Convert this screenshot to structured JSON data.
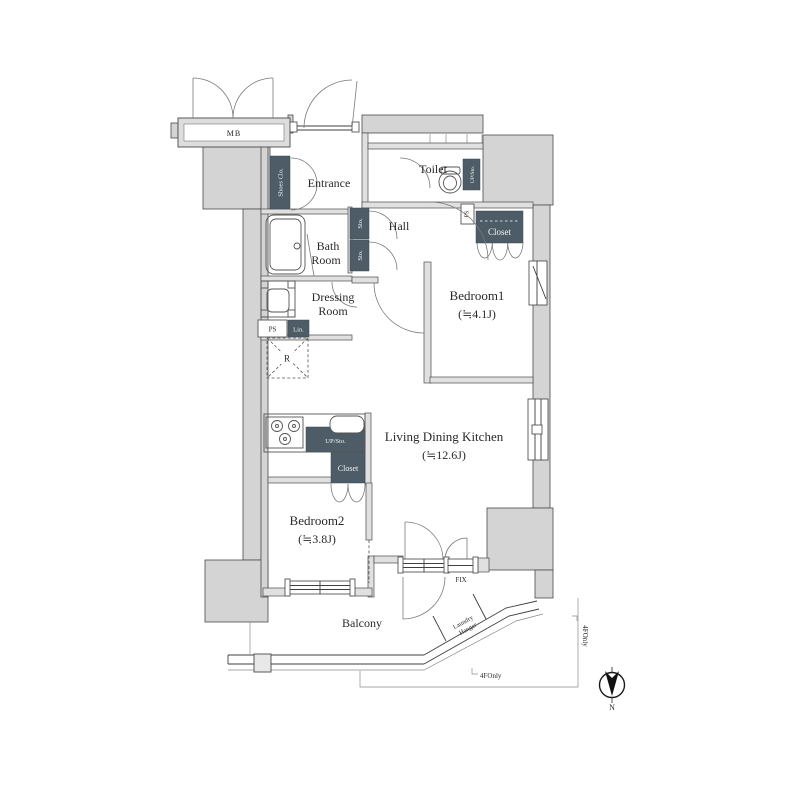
{
  "rooms": {
    "entrance": {
      "label": "Entrance"
    },
    "hall": {
      "label": "Hall"
    },
    "toilet": {
      "label": "Toilet"
    },
    "bath": {
      "line1": "Bath",
      "line2": "Room"
    },
    "dressing": {
      "line1": "Dressing",
      "line2": "Room"
    },
    "bedroom1": {
      "label": "Bedroom1",
      "size": "(≒4.1J)"
    },
    "ldk": {
      "label": "Living Dining Kitchen",
      "size": "(≒12.6J)"
    },
    "bedroom2": {
      "label": "Bedroom2",
      "size": "(≒3.8J)"
    },
    "balcony": {
      "label": "Balcony"
    }
  },
  "storage": {
    "shoes_closet": "Shoes Clo.",
    "sto_upper": "Sto.",
    "sto_lower": "Sto.",
    "up_sto_toilet": "UP/Sto.",
    "up_sto_kitchen": "UP/Sto.",
    "closet_bedroom1": "Closet",
    "closet_bedroom2": "Closet",
    "linen": "Lin.",
    "refrigerator": "R",
    "meter_box": "MB",
    "pipe_space_toilet": "PS",
    "pipe_space_dressing": "PS"
  },
  "annotations": {
    "fix_window": "FIX",
    "laundry_line1": "Laundry",
    "laundry_line2": "Hanger",
    "floor_note_bottom": "4FOnly",
    "floor_note_side": "4FOnly",
    "compass_north": "N"
  },
  "colors": {
    "background": "#ffffff",
    "wall_fill": "#d4d4d4",
    "dark_box": "#4d5c66",
    "line": "#4a4a4a"
  }
}
